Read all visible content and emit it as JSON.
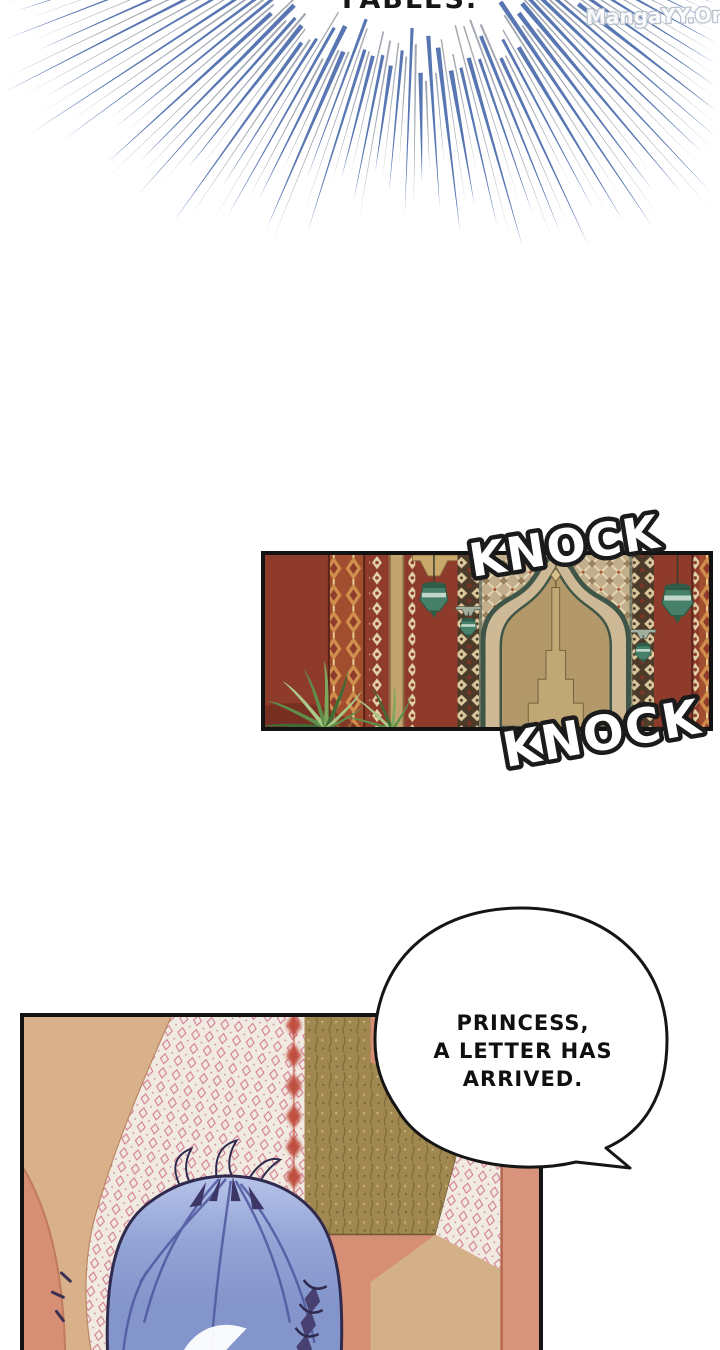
{
  "page": {
    "background": "#ffffff"
  },
  "top_text": {
    "text": "FABLES."
  },
  "watermark": {
    "text": "MangaYY.Org",
    "fill": "#fdfdfd",
    "outline": "#b6bfce"
  },
  "burst": {
    "colors": [
      "#4f6fae",
      "#8d939e"
    ],
    "center": {
      "x": 418,
      "y": -120
    }
  },
  "sfx": {
    "knock_top": "KNOCK",
    "knock_bottom": "KNOCK",
    "fill": "#ffffff",
    "outline": "#1b1b1b"
  },
  "speech_bubble": {
    "lines": [
      "PRINCESS,",
      "A LETTER HAS",
      "ARRIVED."
    ],
    "fill": "#ffffff",
    "outline": "#151515",
    "text_color": "#101010"
  },
  "panels": {
    "door_scene": {
      "border": "#131313",
      "wall": "#8e3b2b",
      "lattice_wall": "#c3ae8c",
      "arch_frame": "#3f5547",
      "door": "#b3996a",
      "lantern": "#47806a",
      "plant_green": "#5f8d4a"
    },
    "bedroom_scene": {
      "border": "#131313",
      "wall": "#d68e74",
      "arch_band": "#d8b08a",
      "wallpaper": "#f1eae1",
      "wallpaper_motif": "#d2748d",
      "gold_tapestry": "#a18851",
      "red_ornament": "#c0503f",
      "hair": "#8495cb",
      "hair_line": "#2f2a4e"
    }
  }
}
